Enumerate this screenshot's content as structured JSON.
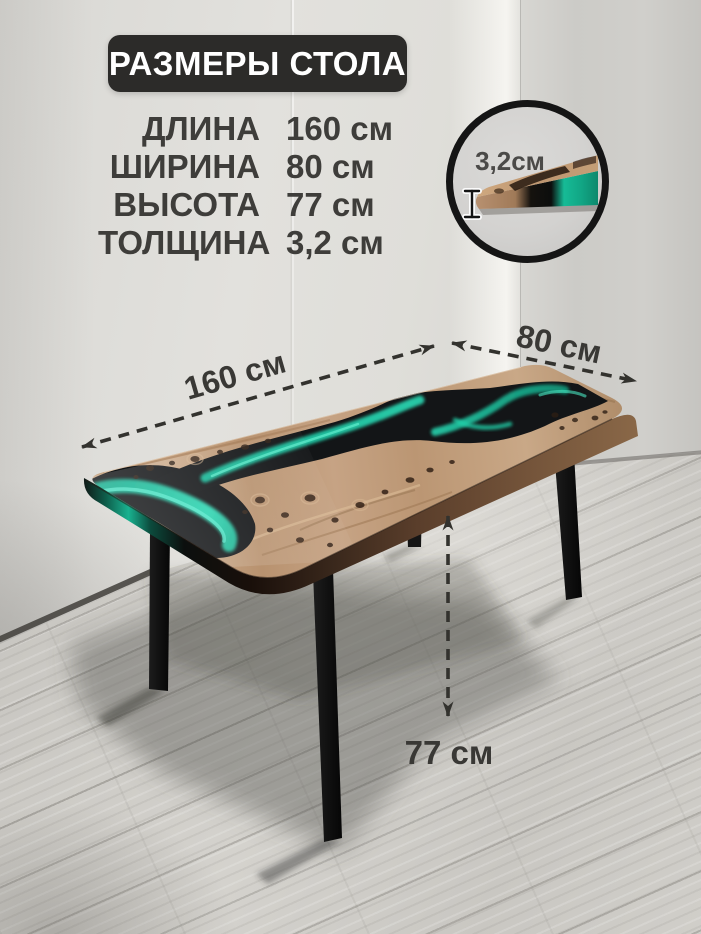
{
  "title": "РАЗМЕРЫ СТОЛА",
  "specs": {
    "rows": [
      {
        "label": "ДЛИНА",
        "value": "160 см"
      },
      {
        "label": "ШИРИНА",
        "value": "80 см"
      },
      {
        "label": "ВЫСОТА",
        "value": "77 см"
      },
      {
        "label": "ТОЛЩИНА",
        "value": "3,2 см"
      }
    ]
  },
  "annotations": {
    "length": "160 см",
    "width": "80 см",
    "height": "77 см",
    "thickness": "3,2см"
  },
  "colors": {
    "badge_bg": "#2c2b29",
    "text": "#3e3d3a",
    "arrow": "#33322e",
    "epoxy_teal": "#1cc3a0",
    "epoxy_black": "#131517",
    "wood": "#bf9c7c",
    "leg": "#141414"
  }
}
